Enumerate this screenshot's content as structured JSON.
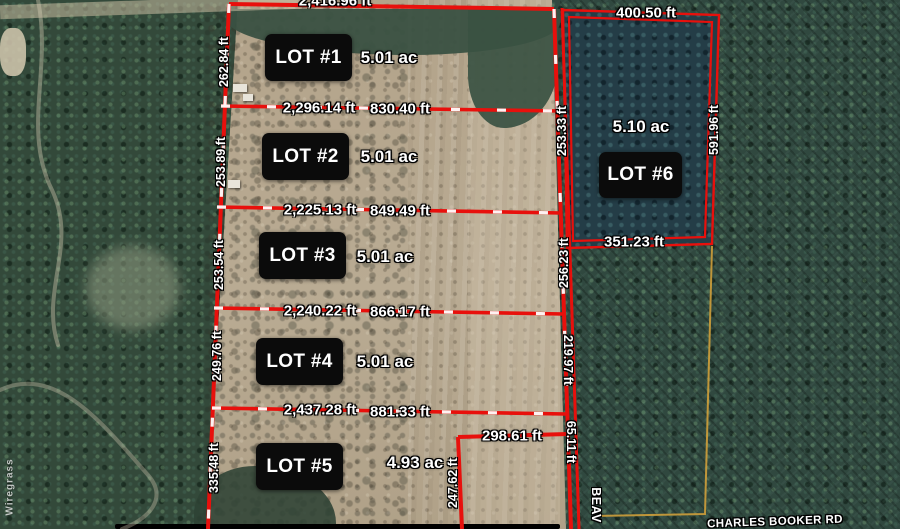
{
  "lots": [
    {
      "label": "LOT #1",
      "acreage": "5.01 ac"
    },
    {
      "label": "LOT #2",
      "acreage": "5.01 ac"
    },
    {
      "label": "LOT #3",
      "acreage": "5.01 ac"
    },
    {
      "label": "LOT #4",
      "acreage": "5.01 ac"
    },
    {
      "label": "LOT #5",
      "acreage": "4.93 ac"
    },
    {
      "label": "LOT #6",
      "acreage": "5.10 ac"
    }
  ],
  "measurements": {
    "top_boundary": "2,416.96 ft",
    "divider1": {
      "west": "2,296.14 ft",
      "east": "830.40 ft"
    },
    "divider2": {
      "west": "2,225.13 ft",
      "east": "849.49 ft"
    },
    "divider3": {
      "west": "2,240.22 ft",
      "east": "866.17 ft"
    },
    "divider4": {
      "west": "2,437.28 ft",
      "east": "881.33 ft"
    },
    "lot1_west": "262.84 ft",
    "lot2_west": "253.89 ft",
    "lot3_west": "253.54 ft",
    "lot4_west": "249.76 ft",
    "lot5_west": "335.48 ft",
    "lot5_north_jog": "298.61 ft",
    "lot5_east_leg": "247.62 ft",
    "road_frontage_upper": "253.33 ft",
    "road_frontage_mid": "256.23 ft",
    "road_frontage_lower": "219.97 ft",
    "road_frontage_bottom": "65.11 ft",
    "lot6_north": "400.50 ft",
    "lot6_south": "351.23 ft",
    "lot6_east": "591.96 ft"
  },
  "roads": {
    "east_road_label": "BEAV",
    "south_road_label": "CHARLES BOOKER RD"
  },
  "watermark": "Wiregrass",
  "colors": {
    "boundary_red": "#e8100c",
    "survey_tick_white": "#ffffff",
    "adjacent_parcel_yellow": "#cf9e3a",
    "lot_label_bg": "#0b0b0b",
    "lot_label_text": "#ffffff",
    "field_tan": "#b5a68e",
    "forest_green": "#33493a"
  }
}
